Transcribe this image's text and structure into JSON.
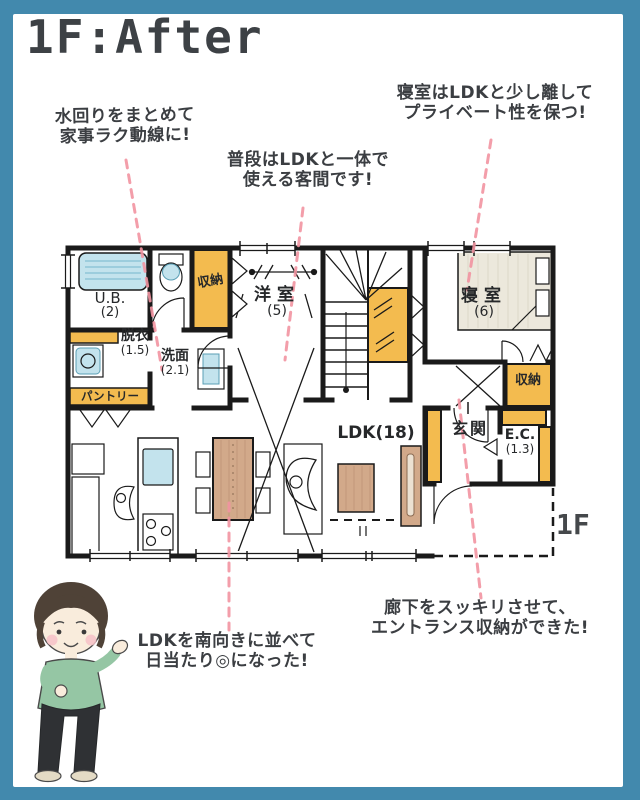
{
  "page": {
    "title": "1F:After",
    "floor_label": "1F",
    "colors": {
      "frame_teal": "#4289ad",
      "accent_yellow": "#f3bb4f",
      "annotation_pink": "#f293a1",
      "wall_black": "#1a1a1a",
      "wood_brown": "#d2a98a",
      "fixture_blue": "#c3e3ed",
      "bed_beige": "#ece8dc",
      "text_dark": "#3b3e42"
    }
  },
  "annotations": {
    "mizumawari": {
      "line1": "水回りをまとめて",
      "line2": "家事ラク動線に!"
    },
    "kyakuma": {
      "line1": "普段はLDKと一体で",
      "line2": "使える客間です!"
    },
    "shinshitsu": {
      "line1": "寝室はLDKと少し離して",
      "line2": "プライベート性を保つ!"
    },
    "rouka": {
      "line1": "廊下をスッキリさせて、",
      "line2": "エントランス収納ができた!"
    },
    "ldk_minami": {
      "line1": "LDKを南向きに並べて",
      "line2": "日当たり◎になった!"
    }
  },
  "rooms": {
    "ub": {
      "name": "U.B.",
      "size": "(2)"
    },
    "datsui": {
      "name": "脱衣",
      "size": "(1.5)"
    },
    "senmen": {
      "name": "洗面",
      "size": "(2.1)"
    },
    "pantry": {
      "name": "パントリー"
    },
    "closet_top": {
      "name": "収納"
    },
    "youshitsu": {
      "name": "洋室",
      "size": "(5)"
    },
    "shinshitsu": {
      "name": "寝室",
      "size": "(6)"
    },
    "closet_right": {
      "name": "収納"
    },
    "genkan": {
      "name": "玄関"
    },
    "ec": {
      "name": "E.C.",
      "size": "(1.3)"
    },
    "ldk": {
      "name": "LDK(18)"
    }
  }
}
